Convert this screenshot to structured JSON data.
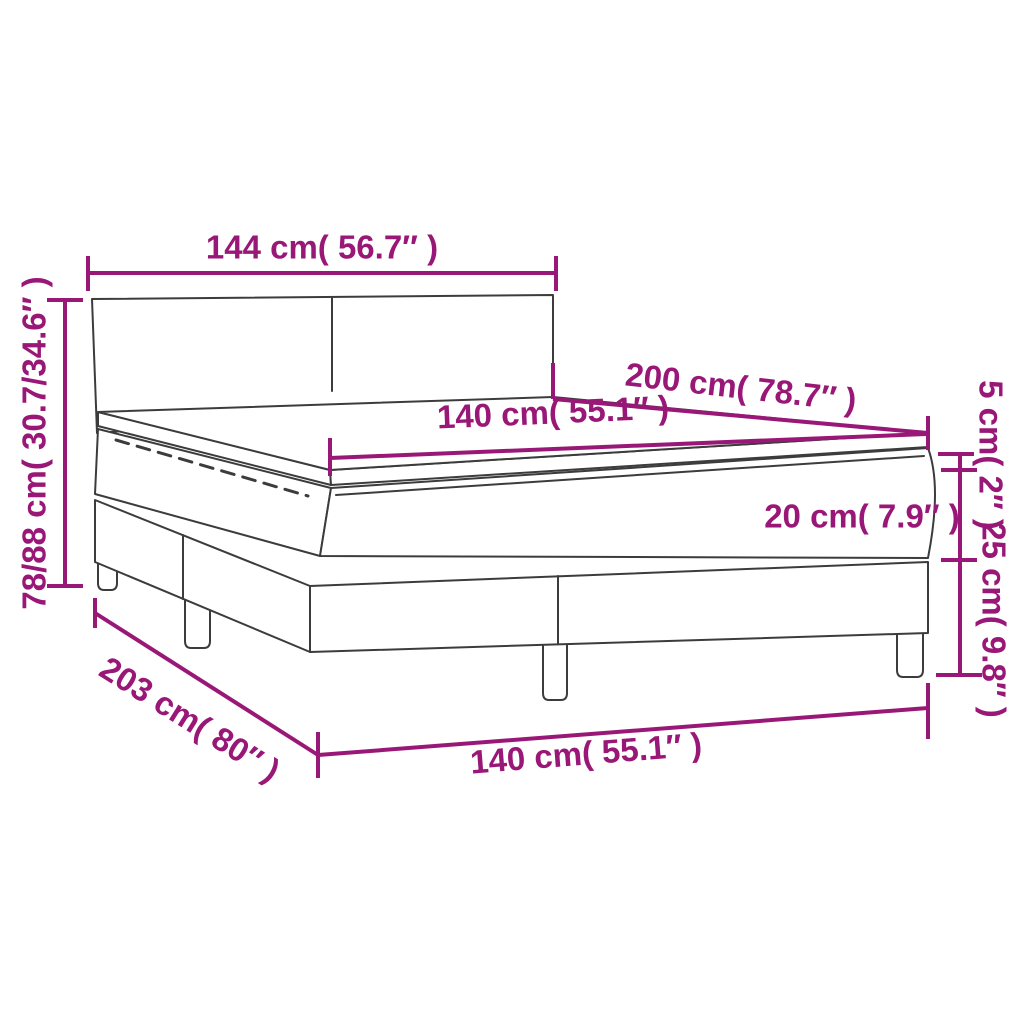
{
  "colors": {
    "accent": "#991877",
    "line": "#3C3C3C",
    "background": "#FFFFFF"
  },
  "dims": {
    "headboard_width": {
      "label": "144 cm( 56.7″ )"
    },
    "bed_height": {
      "label": "78/88 cm( 30.7/34.6″ )"
    },
    "bed_length": {
      "label": "200 cm( 78.7″ )"
    },
    "mattress_width": {
      "label": "140 cm( 55.1″ )"
    },
    "mattress_thickness": {
      "label": "20 cm( 7.9″ )"
    },
    "topper_thickness": {
      "label": "5 cm( 2″ )"
    },
    "base_height": {
      "label": "25 cm( 9.8″ )"
    },
    "base_length": {
      "label": "203 cm( 80″ )"
    },
    "base_width": {
      "label": "140 cm( 55.1″ )"
    }
  }
}
